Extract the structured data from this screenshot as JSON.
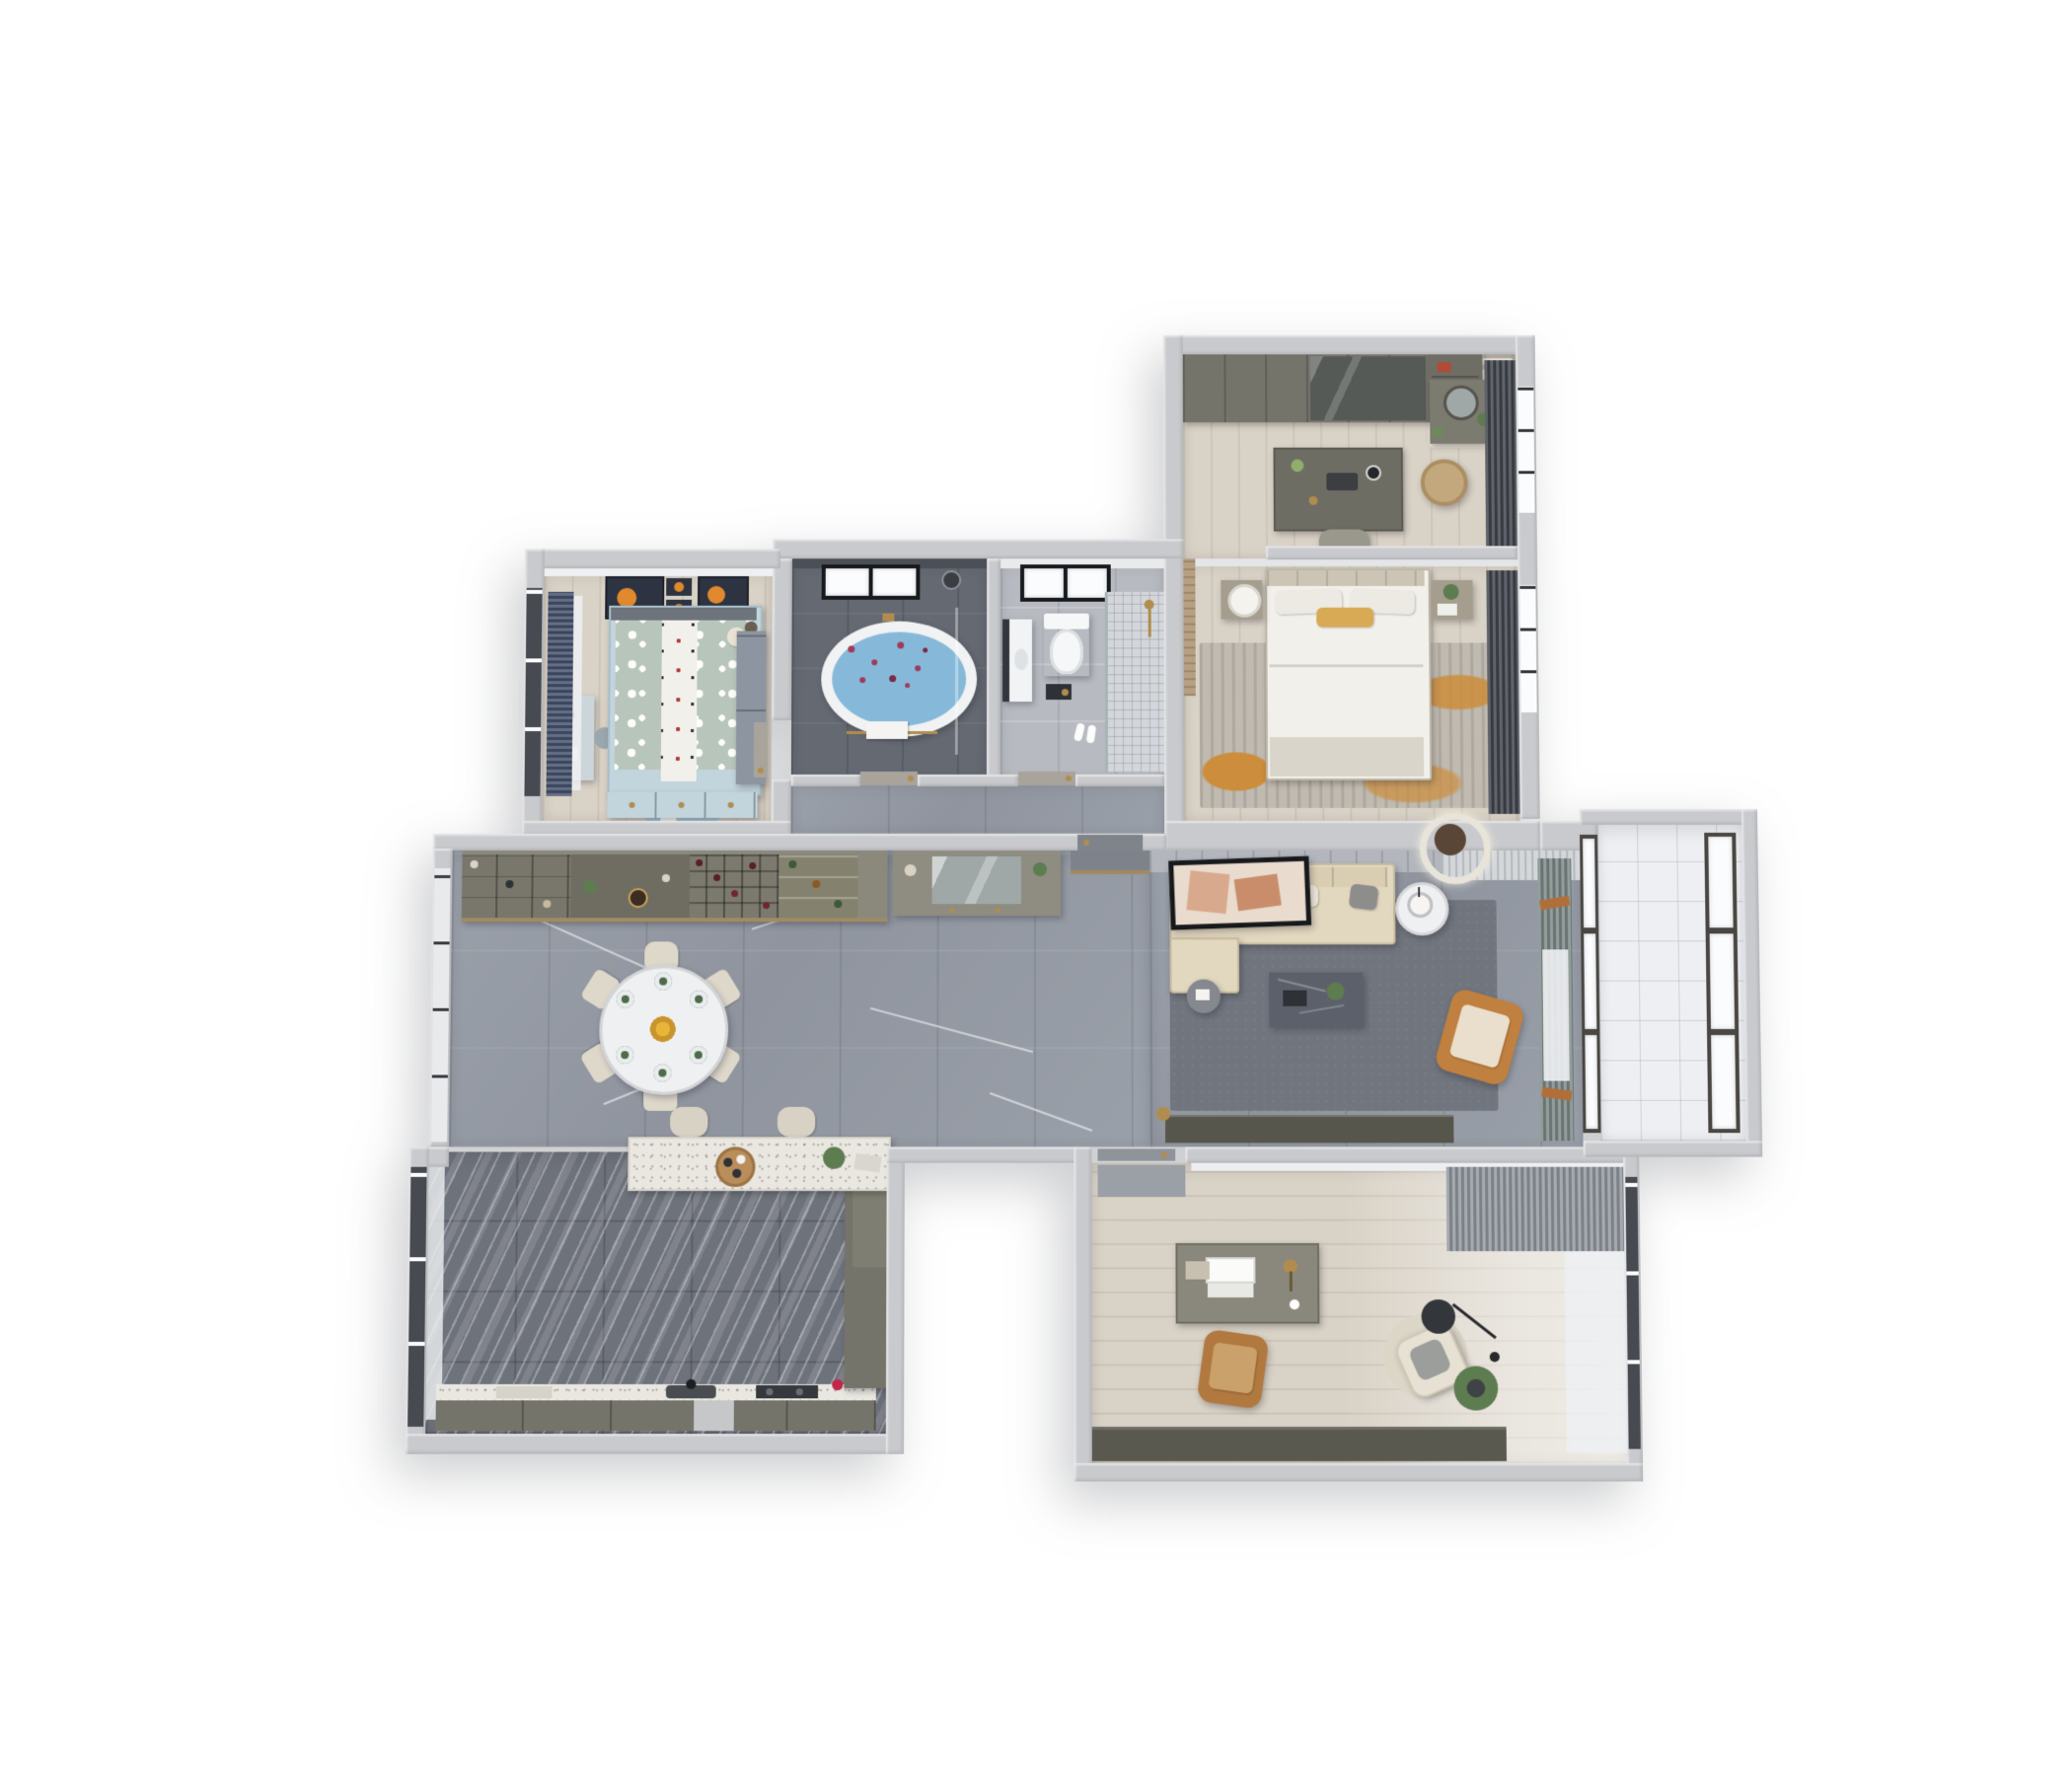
{
  "meta": {
    "type": "3D dollhouse floor-plan render",
    "view": "top-down cutaway of a three-bedroom apartment",
    "text_content": "none — the image contains no readable text, labels or numbers",
    "background": "#ffffff"
  },
  "palette": {
    "wall": "#c9cacd",
    "floorWood": "#d9d2c6",
    "marble": "#959aa3",
    "kitchenTile": "#6e727b",
    "bathDark": "#646972",
    "bathLight": "#b7bbc1",
    "balconyTile": "#edeff2",
    "rugSlate": "#71757d",
    "rugMasterBase": "#c0bab0",
    "rugMasterAccent": "#cc8d3c",
    "sofaBeige": "#e2d7bf",
    "orangeChair": "#c0803f",
    "camel": "#b1793f",
    "olive": "#75746a",
    "oliveLight": "#8b897c",
    "terrazzo": "#e9e7e0",
    "charcoalCurtain": "#42464d",
    "navyCurtain": "#46536e",
    "sageCurtain": "#7e8b89",
    "sheer": "#eef0f3",
    "brass": "#b08d4f",
    "tubWater": "#86b9d9",
    "petal": "#a03a5c",
    "kidsDuvet": "#b8c5bb",
    "kidsRug": "#a6c0cb",
    "kidsBlue": "#c2d4dc",
    "artNavy": "#2d3340",
    "artOrange": "#e0892e",
    "plant": "#5d7c50",
    "doorGray": "#8f939a",
    "white": "#f4f5f6",
    "mirror": "#9fa8a6"
  },
  "rooms": {
    "dressing_room": {
      "label": "Walk-in closet / dressing room",
      "floor": "light oak planks",
      "items": [
        "wardrobe run with glass doors",
        "open shelf tower with bags",
        "vanity table with round mirror and plants",
        "beige patterned rug",
        "central island dressing table with flowers, tray and clock",
        "upholstered stool",
        "rattan laundry basket",
        "charcoal drapes over east windows"
      ]
    },
    "master_bedroom": {
      "label": "Master bedroom",
      "floor": "light oak planks",
      "items": [
        "king bed with panelled headboard",
        "white duvet with ochre accent pillow",
        "two nightstands",
        "white table lamp",
        "plant and book on nightstand",
        "distressed grey rug with rust-orange patches",
        "charcoal drapes and bay window",
        "wood-slat accent wall"
      ]
    },
    "master_bathroom": {
      "label": "Master bathroom",
      "floor": "dark grey marble",
      "items": [
        "freestanding oval tub, blue water with rose petals",
        "brass faucet and towel rail with white towel",
        "black-framed frosted window",
        "handheld shower set",
        "glass screen with brass trim"
      ]
    },
    "guest_bathroom": {
      "label": "Guest bathroom",
      "floor": "light grey stone",
      "items": [
        "wall-hung toilet under black-framed window",
        "white vanity with dark mirror",
        "walk-in shower, glass screen, mosaic floor",
        "brass shower set",
        "white slippers",
        "tissue niche"
      ]
    },
    "kids_bedroom": {
      "label": "Kids bedroom",
      "floor": "light wood planks",
      "items": [
        "bed with sage polka-dot duvet and white runner",
        "teddy bear and reindeer plush",
        "powder-blue under-bed drawers",
        "four space-themed artworks with orange planets",
        "navy curtains on west window",
        "pale blue desk and chair",
        "grey-blue wardrobe",
        "round powder-blue play rug with toys"
      ]
    },
    "dining_area": {
      "label": "Dining area",
      "floor": "grey marble tiles",
      "items": [
        "round marble dining table, six green place settings",
        "yellow flower centerpiece",
        "six cream upholstered chairs",
        "buffet wall with shoe shelves, wine rack and glass display",
        "floor-to-ceiling white french windows"
      ]
    },
    "hallway": {
      "label": "Hallway / entry",
      "floor": "grey marble tiles",
      "items": [
        "entry console with mirror niche and shoe shelves",
        "brass threshold strip",
        "grey panelled entry door",
        "doors to both bathrooms"
      ]
    },
    "living_room": {
      "label": "Living room",
      "floor": "grey marble tiles with slate rug",
      "items": [
        "L-shaped beige sectional sofa with chaise",
        "cushions in cream, grey and terracotta",
        "black-framed abstract artwork on panelled wall",
        "double-ring LED ceiling light",
        "white side table with planter lamp",
        "small dark side table with book",
        "charcoal marble coffee table with tray and plant",
        "terracotta leather armchair",
        "sage and terracotta curtains with sheers",
        "dark media console",
        "brass floor lamp"
      ]
    },
    "balcony": {
      "label": "East balcony",
      "floor": "white tile",
      "items": [
        "bronze-framed triple window wall",
        "white tiled floor"
      ]
    },
    "kitchen": {
      "label": "Kitchen",
      "floor": "dark striped marble tiles",
      "items": [
        "white terrazzo breakfast bar with wooden tray, plant and board",
        "two cream bar stools",
        "olive cabinet run with terrazzo worktop",
        "sink with black faucet",
        "dark two-burner cooktop",
        "integrated dishwasher",
        "tall pantry column",
        "red fire extinguisher",
        "black-framed west windows with sheer curtains"
      ]
    },
    "study": {
      "label": "Study",
      "floor": "light oak planks",
      "items": [
        "writing desk with open laptop, brass lamp, books and coffee",
        "camel leather desk chair",
        "door mat at entry",
        "cream lounge chair on round rug",
        "black arc floor lamp with disc shade",
        "potted palm",
        "grey drape and sheer window curtains",
        "long dark credenza bookcase"
      ]
    },
    "exterior": {
      "label": "Exterior",
      "items": [
        "white backdrop",
        "soft drop shadow under stepped building outline"
      ]
    }
  }
}
